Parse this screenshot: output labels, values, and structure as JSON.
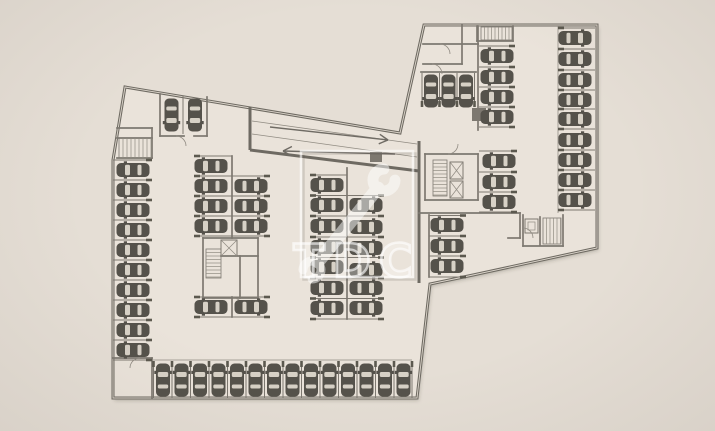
{
  "meta": {
    "description": "Architectural floor plan of an underground parking level with car stalls, ramp arrows, stair cores and a semi-transparent logo watermark"
  },
  "canvas": {
    "width": 715,
    "height": 431
  },
  "colors": {
    "bg": "#e5ded5",
    "floor": "#eae3da",
    "wall_dark": "#6e6a62",
    "wall_mid": "#7d7870",
    "line_thin": "#908b82",
    "double_wall_core": "#ddd6cc",
    "tick": "#5c594f",
    "car_body": "#55524b",
    "car_window": "#d7d1c6",
    "arrow": "#6f6b64",
    "watermark_white": "#ffffff"
  },
  "plan": {
    "outline": [
      [
        125,
        87
      ],
      [
        400,
        133
      ],
      [
        424,
        25
      ],
      [
        597,
        25
      ],
      [
        597,
        248
      ],
      [
        473,
        275
      ],
      [
        430,
        284
      ],
      [
        417,
        398
      ],
      [
        113,
        398
      ],
      [
        113,
        160
      ]
    ],
    "thick_walls": [
      [
        419,
        141,
        419,
        283
      ],
      [
        250,
        150,
        419,
        171
      ],
      [
        250,
        107,
        250,
        150
      ]
    ],
    "walls": [
      [
        160,
        94,
        160,
        136
      ],
      [
        207,
        97,
        207,
        136
      ],
      [
        160,
        136,
        184,
        136
      ],
      [
        194,
        136,
        207,
        136
      ],
      [
        117,
        128,
        152,
        128
      ],
      [
        152,
        128,
        152,
        158
      ],
      [
        117,
        158,
        152,
        158
      ],
      [
        117,
        138,
        152,
        138
      ],
      [
        232,
        156,
        232,
        238
      ],
      [
        232,
        297,
        232,
        317
      ],
      [
        347,
        168,
        347,
        319
      ],
      [
        203,
        238,
        258,
        238
      ],
      [
        258,
        238,
        258,
        298
      ],
      [
        203,
        298,
        258,
        298
      ],
      [
        203,
        238,
        203,
        298
      ],
      [
        221,
        256,
        258,
        256
      ],
      [
        240,
        256,
        240,
        298
      ],
      [
        113,
        358,
        152,
        358
      ],
      [
        152,
        358,
        152,
        398
      ],
      [
        423,
        44,
        478,
        44
      ],
      [
        462,
        25,
        462,
        64
      ],
      [
        423,
        64,
        462,
        64
      ],
      [
        478,
        26,
        478,
        44
      ],
      [
        477,
        26,
        477,
        41
      ],
      [
        513,
        26,
        513,
        41
      ],
      [
        477,
        41,
        513,
        41
      ],
      [
        478,
        44,
        478,
        130
      ],
      [
        421,
        72,
        476,
        72
      ],
      [
        419,
        213,
        520,
        213
      ],
      [
        520,
        213,
        520,
        238
      ],
      [
        508,
        238,
        520,
        238
      ],
      [
        425,
        154,
        478,
        154
      ],
      [
        478,
        154,
        478,
        200
      ],
      [
        425,
        200,
        478,
        200
      ],
      [
        425,
        154,
        425,
        200
      ],
      [
        429,
        215,
        429,
        277
      ],
      [
        523,
        215,
        523,
        246
      ],
      [
        563,
        215,
        563,
        246
      ],
      [
        523,
        246,
        563,
        246
      ],
      [
        540,
        217,
        540,
        245
      ]
    ],
    "thin_lines": [
      [
        558,
        26,
        558,
        213
      ],
      [
        153,
        360,
        412,
        360
      ],
      [
        252,
        121,
        417,
        144
      ],
      [
        252,
        134,
        417,
        157
      ]
    ],
    "blocks": [
      [
        370,
        152,
        12,
        10
      ],
      [
        472,
        108,
        14,
        13
      ]
    ],
    "divider_groups": [
      {
        "name": "left-wall-stalls",
        "fixed": "y",
        "values": [
          160,
          180,
          200,
          220,
          240,
          260,
          280,
          300,
          320,
          340,
          360
        ],
        "from": 113,
        "to": 152,
        "tick": "to"
      },
      {
        "name": "top-room-stall",
        "fixed": "x",
        "values": [
          183
        ],
        "from": 96,
        "to": 134,
        "tick": "none"
      },
      {
        "name": "bay1-left",
        "fixed": "y",
        "values": [
          156,
          176,
          196,
          216,
          236
        ],
        "from": 194,
        "to": 232,
        "tick": "from"
      },
      {
        "name": "bay1-right",
        "fixed": "y",
        "values": [
          176,
          196,
          216,
          236
        ],
        "from": 232,
        "to": 270,
        "tick": "to"
      },
      {
        "name": "bay1-below-core-l",
        "fixed": "y",
        "values": [
          297,
          317
        ],
        "from": 194,
        "to": 232,
        "tick": "from"
      },
      {
        "name": "bay1-below-core-r",
        "fixed": "y",
        "values": [
          297,
          317
        ],
        "from": 232,
        "to": 270,
        "tick": "to"
      },
      {
        "name": "bay2-left",
        "fixed": "y",
        "values": [
          175,
          195.5,
          216,
          237,
          257.5,
          278,
          298.5,
          319
        ],
        "from": 310,
        "to": 347,
        "tick": "from"
      },
      {
        "name": "bay2-right",
        "fixed": "y",
        "values": [
          195.5,
          216,
          237,
          257.5,
          278,
          298.5,
          319
        ],
        "from": 347,
        "to": 384,
        "tick": "to"
      },
      {
        "name": "bottom-row",
        "fixed": "x",
        "values": [
          153.5,
          172,
          190.5,
          209,
          227.5,
          246,
          264.5,
          283,
          301.5,
          320,
          338.5,
          357,
          375.5,
          394,
          412
        ],
        "from": 361,
        "to": 398,
        "tick": "from"
      },
      {
        "name": "ne-top-vertical",
        "fixed": "x",
        "values": [
          422,
          439.5,
          457,
          474.5
        ],
        "from": 73,
        "to": 107,
        "tick": "to"
      },
      {
        "name": "ne-left-upper",
        "fixed": "y",
        "values": [
          46,
          67,
          87,
          107,
          127
        ],
        "from": 479,
        "to": 515,
        "tick": "to"
      },
      {
        "name": "ne-left-lower",
        "fixed": "y",
        "values": [
          151,
          172,
          192,
          212
        ],
        "from": 479,
        "to": 517,
        "tick": "to"
      },
      {
        "name": "ne-right-wall",
        "fixed": "y",
        "values": [
          28,
          49,
          70,
          90,
          109,
          129,
          150,
          170,
          190,
          210
        ],
        "from": 558,
        "to": 595,
        "tick": "from"
      },
      {
        "name": "se-group",
        "fixed": "y",
        "values": [
          215.5,
          236,
          256,
          277
        ],
        "from": 429,
        "to": 466,
        "tick": "to"
      }
    ],
    "car_groups": [
      {
        "name": "left-wall-column",
        "x": 133,
        "ys": [
          170,
          190,
          210,
          230,
          250,
          270,
          290,
          310,
          330,
          350
        ],
        "rot": -90
      },
      {
        "name": "top-room-cars",
        "y": 115,
        "xs": [
          171.5,
          195
        ],
        "rot": 180
      },
      {
        "name": "bay1-left-cars",
        "x": 211,
        "ys": [
          166,
          186,
          206,
          226
        ],
        "rot": -90
      },
      {
        "name": "bay1-right-cars",
        "x": 251,
        "ys": [
          186,
          206,
          226
        ],
        "rot": 90
      },
      {
        "name": "bay1-below-core-left",
        "x": 211,
        "ys": [
          307
        ],
        "rot": -90
      },
      {
        "name": "bay1-below-core-right",
        "x": 251,
        "ys": [
          307
        ],
        "rot": 90
      },
      {
        "name": "bay2-left-cars",
        "x": 327,
        "ys": [
          185,
          205,
          226,
          247,
          267,
          288,
          308
        ],
        "rot": -90
      },
      {
        "name": "bay2-right-cars",
        "x": 366,
        "ys": [
          205,
          227,
          248,
          270,
          288,
          308
        ],
        "rot": 90
      },
      {
        "name": "bottom-row-cars",
        "y": 380,
        "xs": [
          163,
          181.5,
          200,
          218.5,
          237,
          255.5,
          274,
          292.5,
          311,
          329.5,
          348,
          366.5,
          385,
          403.5
        ],
        "rot": 0
      },
      {
        "name": "ne-vertical-cars",
        "y": 91,
        "xs": [
          431,
          448.5,
          466
        ],
        "rot": 180
      },
      {
        "name": "ne-left-upper-cars",
        "x": 497,
        "ys": [
          56,
          77,
          97,
          117
        ],
        "rot": -90
      },
      {
        "name": "ne-left-lower-cars",
        "x": 499,
        "ys": [
          161,
          182,
          202
        ],
        "rot": -90
      },
      {
        "name": "ne-right-cars",
        "x": 575,
        "ys": [
          38,
          59,
          80,
          100,
          119,
          140,
          160,
          180,
          200
        ],
        "rot": 90
      },
      {
        "name": "se-cars",
        "x": 447,
        "ys": [
          225,
          246,
          266
        ],
        "rot": -90
      }
    ],
    "stair_hatches": [
      {
        "x": 119,
        "y": 138,
        "w": 33,
        "h": 20,
        "dir": "v",
        "step": 4
      },
      {
        "x": 206,
        "y": 249,
        "w": 15,
        "h": 29,
        "dir": "h",
        "step": 3.5
      },
      {
        "x": 481,
        "y": 27,
        "w": 31,
        "h": 13,
        "dir": "v",
        "step": 3.5
      },
      {
        "x": 433,
        "y": 160,
        "w": 14,
        "h": 36,
        "dir": "h",
        "step": 3.5
      },
      {
        "x": 543,
        "y": 218,
        "w": 18,
        "h": 26,
        "dir": "v",
        "step": 3.5
      }
    ],
    "elevator_boxes": [
      [
        221,
        240,
        16,
        16
      ],
      [
        450,
        162,
        13,
        17
      ],
      [
        450,
        181,
        13,
        17
      ]
    ],
    "inner_square_boxes": [
      [
        525,
        219,
        13,
        14
      ]
    ],
    "door_arcs": [
      [
        176,
        136,
        186,
        146,
        1
      ],
      [
        233,
        298,
        243,
        308,
        1
      ],
      [
        448,
        154,
        458,
        144,
        0
      ],
      [
        440,
        44,
        450,
        54,
        1
      ],
      [
        432,
        64,
        442,
        74,
        1
      ],
      [
        523,
        228,
        533,
        238,
        1
      ],
      [
        140,
        358,
        130,
        368,
        0
      ]
    ],
    "ramp_arrows": [
      {
        "name": "ramp-arrow-right",
        "x1": 270,
        "y1": 127,
        "x2": 388,
        "y2": 140
      },
      {
        "name": "ramp-arrow-left",
        "x1": 395,
        "y1": 154,
        "x2": 283,
        "y2": 151
      }
    ]
  },
  "watermark": {
    "letters": "TDC",
    "frame": {
      "x": 301,
      "y": 151,
      "w": 112,
      "h": 126
    },
    "letters_center_x": 357,
    "letters_baseline_y": 277,
    "font_size": 46,
    "wrench": {
      "x1": 318,
      "y1": 262,
      "x2": 378,
      "y2": 188,
      "bar_width": 13,
      "head_cx": 384,
      "head_cy": 180,
      "head_r": 11,
      "head_stroke": 11,
      "tail_cx": 312,
      "tail_cy": 270,
      "tail_r": 9,
      "tail_stroke": 9
    }
  }
}
